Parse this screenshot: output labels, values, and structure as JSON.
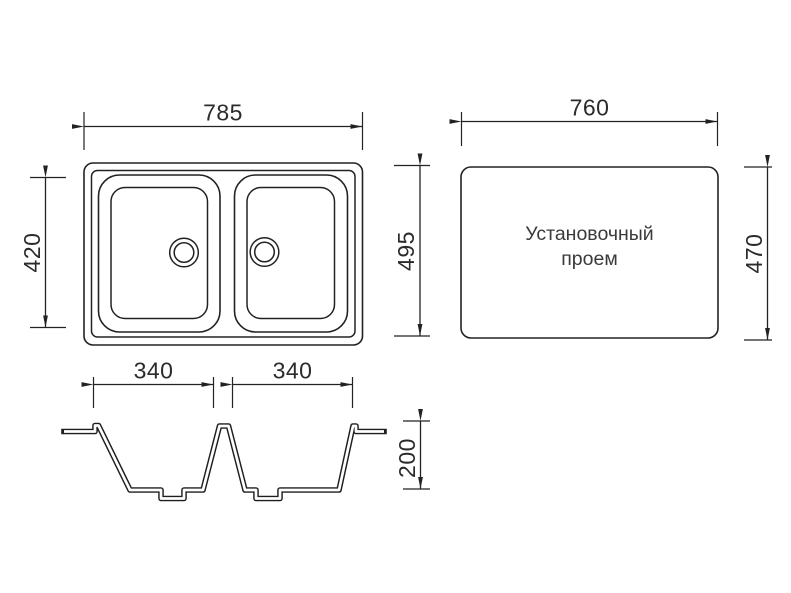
{
  "page": {
    "background_color": "#ffffff",
    "line_color": "#222222",
    "text_color": "#2b2b2b"
  },
  "dimensions": {
    "sink_overall_width": "785",
    "sink_bowl_zone_height": "420",
    "sink_overall_depth": "495",
    "opening_width": "760",
    "opening_height": "470",
    "bowl_left_width": "340",
    "bowl_right_width": "340",
    "bowl_depth": "200"
  },
  "install_opening": {
    "label_line1": "Установочный",
    "label_line2": "проем"
  }
}
